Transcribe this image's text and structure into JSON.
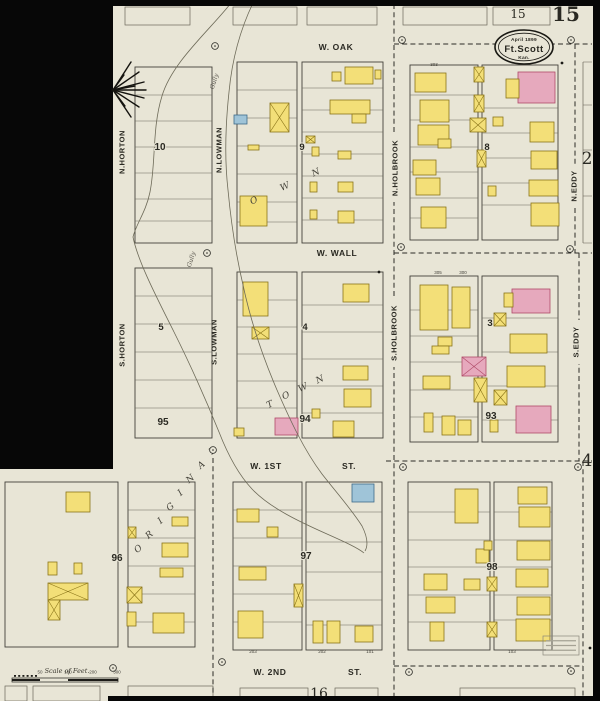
{
  "sheet": {
    "number_bold": "15",
    "number_boxed": "15",
    "adjacent_sheet_bottom": "16",
    "title": {
      "line1": "April 1899",
      "line2": "Ft.Scott",
      "line3": "Kan."
    },
    "scale_label": "Scale of Feet.",
    "scale_ticks": [
      "50",
      "100",
      "200",
      "300"
    ],
    "corner_numbers": [
      {
        "t": "2",
        "x": 587,
        "y": 164
      },
      {
        "t": "4",
        "x": 587,
        "y": 466
      }
    ]
  },
  "palette": {
    "paper": "#e8e5d6",
    "frame_yellow": "#f3df78",
    "frame_yellow_stroke": "#8a7418",
    "brick_pink": "#e6a9bd",
    "brick_pink_stroke": "#b04a68",
    "special_blue": "#9fc4d8",
    "special_blue_stroke": "#3c6b8a",
    "line": "#6a675a",
    "block_line": "#43413a",
    "ink": "#2a2922",
    "mask": "#070707"
  },
  "streets": {
    "horizontal": [
      {
        "t": "W. OAK",
        "x": 336,
        "y": 50
      },
      {
        "t": "W. WALL",
        "x": 337,
        "y": 256
      },
      {
        "t": "W. 1ST",
        "x": 266,
        "y": 469
      },
      {
        "t": "ST.",
        "x": 349,
        "y": 469
      },
      {
        "t": "W. 2ND",
        "x": 270,
        "y": 675
      },
      {
        "t": "ST.",
        "x": 355,
        "y": 675
      }
    ],
    "vertical": [
      {
        "t": "N.HORTON",
        "x": 122,
        "y": 152,
        "pat": 0
      },
      {
        "t": "S.HORTON",
        "x": 122,
        "y": 345,
        "pat": 0
      },
      {
        "t": "N.LOWMAN",
        "x": 219,
        "y": 150,
        "pat": 0
      },
      {
        "t": "S.LOWMAN",
        "x": 214,
        "y": 342,
        "pat": 0
      },
      {
        "t": "N.HOLBROOK",
        "x": 395,
        "y": 168,
        "pat": 1
      },
      {
        "t": "S.HOLBROOK",
        "x": 394,
        "y": 333,
        "pat": 1
      },
      {
        "t": "N.EDDY",
        "x": 574,
        "y": 186,
        "pat": 1
      },
      {
        "t": "S.EDDY",
        "x": 576,
        "y": 342,
        "pat": 1
      }
    ]
  },
  "block_numbers": [
    {
      "t": "10",
      "x": 160,
      "y": 150
    },
    {
      "t": "9",
      "x": 302,
      "y": 150
    },
    {
      "t": "8",
      "x": 487,
      "y": 150
    },
    {
      "t": "5",
      "x": 161,
      "y": 330
    },
    {
      "t": "4",
      "x": 305,
      "y": 330
    },
    {
      "t": "3",
      "x": 490,
      "y": 326
    },
    {
      "t": "95",
      "x": 163,
      "y": 425
    },
    {
      "t": "94",
      "x": 305,
      "y": 422
    },
    {
      "t": "93",
      "x": 491,
      "y": 419
    },
    {
      "t": "96",
      "x": 117,
      "y": 561
    },
    {
      "t": "97",
      "x": 306,
      "y": 559
    },
    {
      "t": "98",
      "x": 492,
      "y": 570
    }
  ],
  "diagonal_letters": [
    {
      "t": "O",
      "x": 140,
      "y": 551,
      "r": -40
    },
    {
      "t": "R",
      "x": 151,
      "y": 537,
      "r": -40
    },
    {
      "t": "I",
      "x": 162,
      "y": 523,
      "r": -40
    },
    {
      "t": "G",
      "x": 172,
      "y": 509,
      "r": -40
    },
    {
      "t": "I",
      "x": 182,
      "y": 495,
      "r": -40
    },
    {
      "t": "N",
      "x": 192,
      "y": 481,
      "r": -40
    },
    {
      "t": "A",
      "x": 203,
      "y": 467,
      "r": -40
    },
    {
      "t": "L",
      "x": 214,
      "y": 453,
      "r": -40
    },
    {
      "t": "T",
      "x": 271,
      "y": 407,
      "r": -25
    },
    {
      "t": "O",
      "x": 287,
      "y": 398,
      "r": -25
    },
    {
      "t": "W",
      "x": 304,
      "y": 390,
      "r": -25
    },
    {
      "t": "N",
      "x": 321,
      "y": 382,
      "r": -25
    },
    {
      "t": "O",
      "x": 255,
      "y": 203,
      "r": -25
    },
    {
      "t": "W",
      "x": 286,
      "y": 189,
      "r": -25
    },
    {
      "t": "N",
      "x": 317,
      "y": 175,
      "r": -25
    }
  ],
  "gully_labels": [
    {
      "t": "Gully",
      "x": 216,
      "y": 82,
      "r": -72
    },
    {
      "t": "Gully",
      "x": 193,
      "y": 260,
      "r": -72
    }
  ],
  "tiny_numbers": [
    {
      "t": "303",
      "x": 434,
      "y": 66
    },
    {
      "t": "305",
      "x": 438,
      "y": 274
    },
    {
      "t": "300",
      "x": 463,
      "y": 274
    },
    {
      "t": "203",
      "x": 253,
      "y": 653
    },
    {
      "t": "202",
      "x": 322,
      "y": 653
    },
    {
      "t": "101",
      "x": 370,
      "y": 653
    },
    {
      "t": "103",
      "x": 512,
      "y": 653
    }
  ],
  "blocks": [
    [
      135,
      67,
      77,
      176,
      [
        95,
        121,
        147,
        173,
        199,
        221
      ]
    ],
    [
      237,
      62,
      60,
      181,
      [
        90,
        118,
        146,
        174,
        202,
        222
      ]
    ],
    [
      302,
      62,
      81,
      181,
      [
        88,
        110,
        132,
        154,
        176,
        198,
        220
      ]
    ],
    [
      410,
      65,
      68,
      175,
      [
        95,
        120,
        147,
        172,
        198,
        218
      ]
    ],
    [
      482,
      65,
      76,
      175,
      [
        108,
        133,
        158,
        183,
        205
      ]
    ],
    [
      135,
      268,
      77,
      170,
      [
        296,
        324,
        352,
        380,
        408
      ]
    ],
    [
      237,
      272,
      60,
      166,
      [
        300,
        327,
        354,
        381,
        408
      ]
    ],
    [
      302,
      272,
      81,
      166,
      [
        305,
        332,
        359,
        386,
        413
      ]
    ],
    [
      410,
      276,
      68,
      166,
      [
        310,
        336,
        362,
        390,
        417
      ]
    ],
    [
      482,
      276,
      76,
      166,
      [
        318,
        352,
        386,
        420
      ]
    ],
    [
      5,
      482,
      113,
      165,
      []
    ],
    [
      128,
      482,
      67,
      165,
      [
        510,
        538,
        566,
        594,
        622
      ]
    ],
    [
      233,
      482,
      69,
      168,
      [
        510,
        538,
        566,
        594,
        622
      ]
    ],
    [
      306,
      482,
      76,
      168,
      [
        512,
        542,
        572,
        600,
        625
      ]
    ],
    [
      408,
      482,
      82,
      168,
      [
        512,
        540,
        567,
        595,
        622
      ]
    ],
    [
      494,
      482,
      58,
      168,
      [
        512,
        540,
        567,
        595,
        620
      ]
    ]
  ],
  "partial_blocks_top": [
    [
      125,
      7,
      65,
      18
    ],
    [
      233,
      7,
      64,
      18
    ],
    [
      307,
      7,
      70,
      18
    ],
    [
      403,
      7,
      84,
      18
    ],
    [
      493,
      7,
      57,
      18
    ]
  ],
  "partial_blocks_bottom": [
    [
      5,
      686,
      22,
      15
    ],
    [
      33,
      686,
      67,
      15
    ],
    [
      128,
      686,
      85,
      15
    ],
    [
      240,
      688,
      68,
      13
    ],
    [
      335,
      688,
      43,
      13
    ],
    [
      460,
      688,
      115,
      13
    ]
  ],
  "block2_strip": {
    "x": 583,
    "ticks": [
      62,
      105,
      150,
      196,
      243
    ],
    "x2": 592
  },
  "buildings": [
    [
      234,
      115,
      13,
      9,
      "b",
      0
    ],
    [
      270,
      103,
      19,
      29,
      "y",
      1
    ],
    [
      248,
      145,
      11,
      5,
      "y",
      0
    ],
    [
      240,
      196,
      27,
      30,
      "y",
      0
    ],
    [
      345,
      67,
      28,
      17,
      "y",
      0
    ],
    [
      332,
      72,
      9,
      9,
      "y",
      0
    ],
    [
      330,
      100,
      40,
      14,
      "y",
      0
    ],
    [
      352,
      114,
      14,
      9,
      "y",
      0
    ],
    [
      338,
      151,
      13,
      8,
      "y",
      0
    ],
    [
      338,
      182,
      15,
      10,
      "y",
      0
    ],
    [
      338,
      211,
      16,
      12,
      "y",
      0
    ],
    [
      312,
      147,
      7,
      9,
      "y",
      0
    ],
    [
      310,
      182,
      7,
      10,
      "y",
      0
    ],
    [
      310,
      210,
      7,
      9,
      "y",
      0
    ],
    [
      306,
      136,
      9,
      7,
      "y",
      1
    ],
    [
      375,
      70,
      6,
      9,
      "y",
      0
    ],
    [
      415,
      73,
      31,
      19,
      "y",
      0
    ],
    [
      420,
      100,
      29,
      22,
      "y",
      0
    ],
    [
      418,
      125,
      31,
      20,
      "y",
      0
    ],
    [
      438,
      139,
      13,
      9,
      "y",
      0
    ],
    [
      413,
      160,
      23,
      15,
      "y",
      0
    ],
    [
      416,
      178,
      24,
      17,
      "y",
      0
    ],
    [
      421,
      207,
      25,
      21,
      "y",
      0
    ],
    [
      474,
      67,
      10,
      15,
      "y",
      1
    ],
    [
      474,
      95,
      10,
      17,
      "y",
      1
    ],
    [
      470,
      118,
      16,
      14,
      "y",
      1
    ],
    [
      477,
      150,
      9,
      17,
      "y",
      1
    ],
    [
      518,
      72,
      37,
      31,
      "p",
      0
    ],
    [
      506,
      79,
      13,
      19,
      "y",
      0
    ],
    [
      530,
      122,
      24,
      20,
      "y",
      0
    ],
    [
      531,
      151,
      26,
      18,
      "y",
      0
    ],
    [
      529,
      180,
      29,
      16,
      "y",
      0
    ],
    [
      531,
      203,
      28,
      23,
      "y",
      0
    ],
    [
      493,
      117,
      10,
      9,
      "y",
      0
    ],
    [
      488,
      186,
      8,
      10,
      "y",
      0
    ],
    [
      243,
      282,
      25,
      34,
      "y",
      0
    ],
    [
      252,
      327,
      17,
      12,
      "y",
      1
    ],
    [
      275,
      418,
      23,
      17,
      "p",
      0
    ],
    [
      234,
      428,
      10,
      8,
      "y",
      0
    ],
    [
      343,
      284,
      26,
      18,
      "y",
      0
    ],
    [
      343,
      366,
      25,
      14,
      "y",
      0
    ],
    [
      344,
      389,
      27,
      18,
      "y",
      0
    ],
    [
      333,
      421,
      21,
      16,
      "y",
      0
    ],
    [
      312,
      409,
      8,
      9,
      "y",
      0
    ],
    [
      420,
      285,
      28,
      45,
      "y",
      0
    ],
    [
      452,
      287,
      18,
      41,
      "y",
      0
    ],
    [
      438,
      337,
      14,
      9,
      "y",
      0
    ],
    [
      432,
      346,
      17,
      8,
      "y",
      0
    ],
    [
      462,
      357,
      24,
      19,
      "p",
      1
    ],
    [
      474,
      378,
      13,
      24,
      "y",
      1
    ],
    [
      423,
      376,
      27,
      13,
      "y",
      0
    ],
    [
      424,
      413,
      9,
      19,
      "y",
      0
    ],
    [
      442,
      416,
      13,
      19,
      "y",
      0
    ],
    [
      458,
      420,
      13,
      15,
      "y",
      0
    ],
    [
      512,
      289,
      38,
      24,
      "p",
      0
    ],
    [
      504,
      293,
      9,
      14,
      "y",
      0
    ],
    [
      510,
      334,
      37,
      19,
      "y",
      0
    ],
    [
      507,
      366,
      38,
      21,
      "y",
      0
    ],
    [
      516,
      406,
      35,
      27,
      "p",
      0
    ],
    [
      494,
      313,
      12,
      13,
      "y",
      1
    ],
    [
      494,
      390,
      13,
      15,
      "y",
      1
    ],
    [
      490,
      420,
      8,
      12,
      "y",
      0
    ],
    [
      66,
      492,
      24,
      20,
      "y",
      0
    ],
    [
      48,
      562,
      9,
      13,
      "y",
      0
    ],
    [
      74,
      563,
      8,
      11,
      "y",
      0
    ],
    [
      48,
      583,
      40,
      17,
      "y",
      1
    ],
    [
      48,
      600,
      12,
      20,
      "y",
      1
    ],
    [
      172,
      517,
      16,
      9,
      "y",
      0
    ],
    [
      162,
      543,
      26,
      14,
      "y",
      0
    ],
    [
      160,
      568,
      23,
      9,
      "y",
      0
    ],
    [
      128,
      527,
      8,
      11,
      "y",
      1
    ],
    [
      127,
      587,
      15,
      16,
      "y",
      1
    ],
    [
      127,
      612,
      9,
      14,
      "y",
      0
    ],
    [
      153,
      613,
      31,
      20,
      "y",
      0
    ],
    [
      237,
      509,
      22,
      13,
      "y",
      0
    ],
    [
      267,
      527,
      11,
      10,
      "y",
      0
    ],
    [
      239,
      567,
      27,
      13,
      "y",
      0
    ],
    [
      238,
      611,
      25,
      27,
      "y",
      0
    ],
    [
      294,
      584,
      9,
      23,
      "y",
      1
    ],
    [
      352,
      484,
      22,
      18,
      "b",
      0
    ],
    [
      313,
      621,
      10,
      22,
      "y",
      0
    ],
    [
      327,
      621,
      13,
      22,
      "y",
      0
    ],
    [
      355,
      626,
      18,
      16,
      "y",
      0
    ],
    [
      455,
      489,
      23,
      34,
      "y",
      0
    ],
    [
      424,
      574,
      23,
      16,
      "y",
      0
    ],
    [
      464,
      579,
      16,
      11,
      "y",
      0
    ],
    [
      426,
      597,
      29,
      16,
      "y",
      0
    ],
    [
      430,
      622,
      14,
      19,
      "y",
      0
    ],
    [
      476,
      549,
      13,
      14,
      "y",
      0
    ],
    [
      487,
      577,
      10,
      14,
      "y",
      1
    ],
    [
      487,
      622,
      10,
      15,
      "y",
      1
    ],
    [
      484,
      541,
      8,
      9,
      "y",
      0
    ],
    [
      518,
      487,
      29,
      17,
      "y",
      0
    ],
    [
      519,
      507,
      31,
      20,
      "y",
      0
    ],
    [
      517,
      541,
      33,
      19,
      "y",
      0
    ],
    [
      516,
      569,
      32,
      18,
      "y",
      0
    ],
    [
      517,
      597,
      33,
      18,
      "y",
      0
    ],
    [
      516,
      619,
      34,
      22,
      "y",
      0
    ]
  ],
  "dashed_segments": [
    [
      394,
      4,
      394,
      700
    ],
    [
      394,
      44,
      592,
      44
    ],
    [
      575,
      44,
      575,
      253
    ],
    [
      394,
      253,
      592,
      253
    ],
    [
      579,
      253,
      579,
      461
    ],
    [
      386,
      461,
      592,
      461
    ],
    [
      394,
      666,
      583,
      666
    ],
    [
      583,
      461,
      583,
      700
    ],
    [
      213,
      458,
      213,
      695
    ]
  ],
  "markers": [
    [
      215,
      46
    ],
    [
      402,
      40
    ],
    [
      571,
      40
    ],
    [
      207,
      253
    ],
    [
      401,
      247
    ],
    [
      570,
      249
    ],
    [
      213,
      450
    ],
    [
      403,
      467
    ],
    [
      578,
      467
    ],
    [
      222,
      662
    ],
    [
      409,
      672
    ],
    [
      571,
      671
    ],
    [
      113,
      668
    ]
  ],
  "dots": [
    [
      562,
      63
    ],
    [
      379,
      272
    ],
    [
      590,
      648
    ]
  ],
  "gully_paths": [
    "M231,3 C210,30 172,62 162,96 C152,128 156,162 150,192 C146,212 136,224 133,237 C138,262 158,300 174,332 C190,364 206,400 219,432 C226,450 236,472 252,489 C270,508 300,522 327,534 C345,542 358,548 364,553",
    "M253,3 C240,30 232,60 229,92 C226,120 224,155 228,190 C231,222 236,255 243,285 C250,318 262,355 277,390 C290,420 304,450 322,474 C336,492 352,510 362,526 C366,534 369,544 365,551"
  ],
  "starburst": {
    "cx": 113,
    "cy": 90,
    "rays": [
      [
        18,
        -28
      ],
      [
        26,
        -18
      ],
      [
        31,
        -8
      ],
      [
        33,
        0
      ],
      [
        31,
        8
      ],
      [
        26,
        17
      ],
      [
        18,
        27
      ],
      [
        11,
        -15
      ],
      [
        12,
        16
      ],
      [
        22,
        -4
      ]
    ]
  },
  "masks": [
    [
      0,
      0,
      113,
      469
    ],
    [
      0,
      0,
      600,
      6
    ],
    [
      593,
      0,
      7,
      701
    ],
    [
      108,
      696,
      492,
      5
    ]
  ],
  "stamp": {
    "x": 543,
    "y": 636,
    "w": 36,
    "h": 19
  },
  "scale_bar": {
    "x": 12,
    "y": 678,
    "w": 106,
    "h": 4,
    "tick_xs": [
      40,
      68,
      93,
      117
    ]
  }
}
